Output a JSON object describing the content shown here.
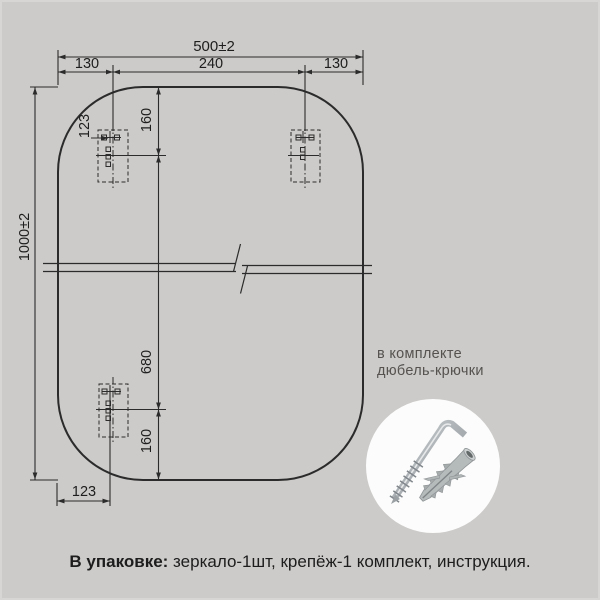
{
  "colors": {
    "background": "#cccbc9",
    "line": "#2b2b2b",
    "dimension_text": "#1e1e1e",
    "note_text": "#55524f",
    "photo_circle_fill": "#fcfcfc",
    "metal": "#b0b5b9",
    "plastic_plug": "#b5babb"
  },
  "dimensions": {
    "total_width": "500±2",
    "top_left_margin": "130",
    "hook_span": "240",
    "top_right_margin": "130",
    "total_height": "1000±2",
    "hook_inset_top": "123",
    "edge_to_hook_top": "160",
    "hook_to_hook": "680",
    "hook_to_edge_bottom": "160",
    "hook_inset_bottom": "123"
  },
  "note": {
    "line1": "в комплекте",
    "line2": "дюбель-крючки"
  },
  "package": {
    "label": "В упаковке:",
    "contents": " зеркало-1шт, крепёж-1 комплект, инструкция."
  },
  "icons": {
    "hook_screw": "hook-screw-icon",
    "wall_plug": "wall-plug-icon"
  }
}
